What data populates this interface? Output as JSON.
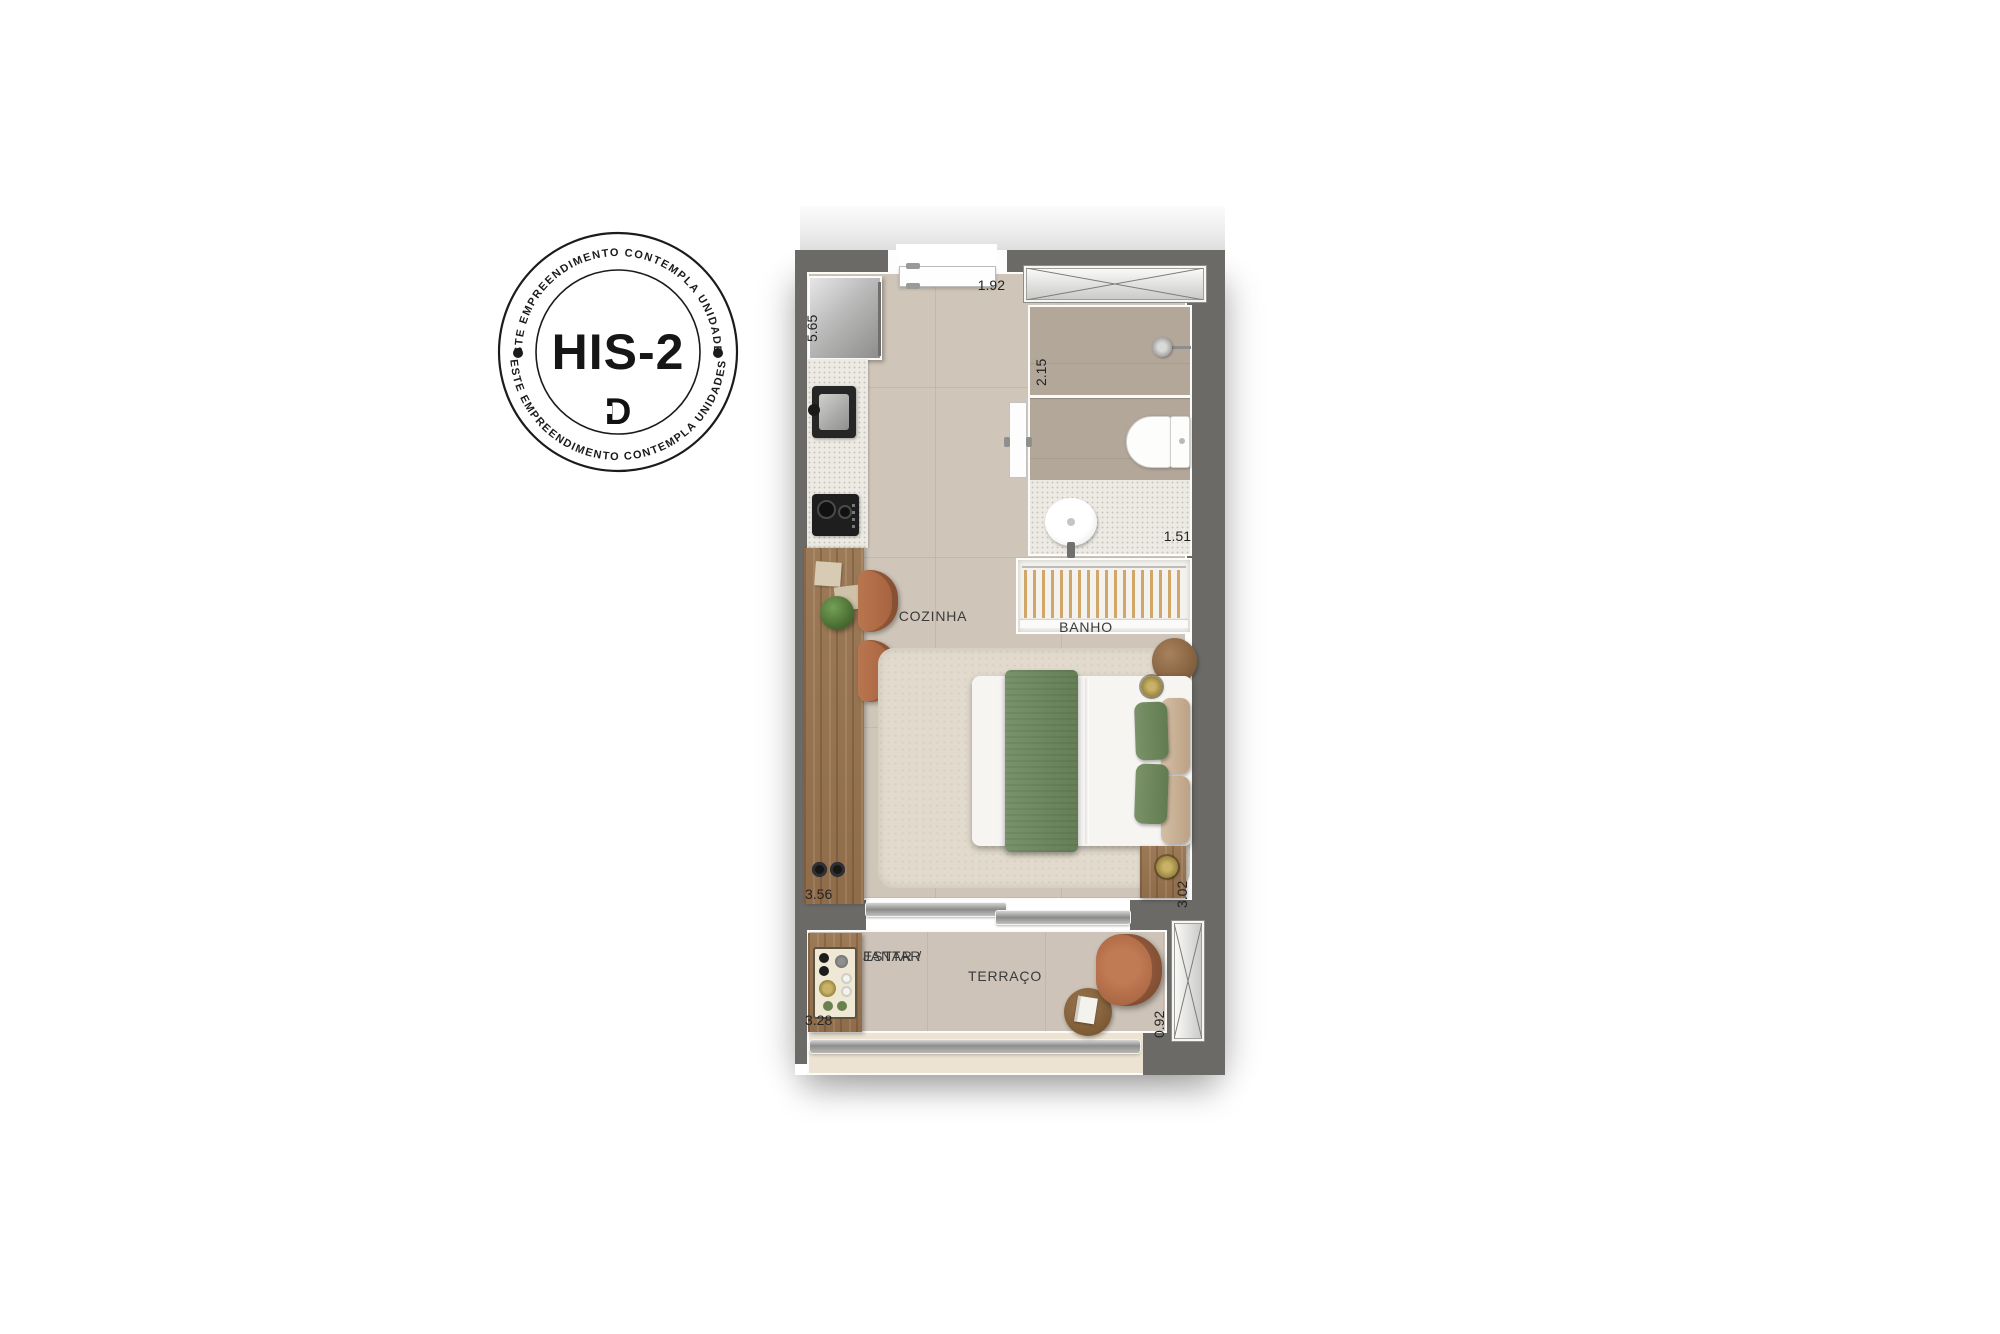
{
  "badge": {
    "ring_text_top": "ESTE EMPREENDIMENTO CONTEMPLA UNIDADES",
    "ring_text_bottom": "ESTE EMPREENDIMENTO CONTEMPLA UNIDADES",
    "title": "HIS-2",
    "logo_letter": "D",
    "ink_color": "#1b1b1b"
  },
  "floor_plan": {
    "rooms": {
      "cozinha": "COZINHA",
      "banho": "BANHO",
      "estar_jantar_line1": "ESTAR /",
      "estar_jantar_line2": "JANTAR",
      "terraco": "TERRAÇO"
    },
    "dimensions": {
      "cozinha_depth": "5.65",
      "entrada_width": "1.92",
      "banho_depth": "2.15",
      "banho_width": "1.51",
      "estar_width": "3.56",
      "estar_depth": "3.02",
      "terraco_width": "3.28",
      "terraco_depth": "0.92"
    },
    "colors": {
      "wall": "#6b6a67",
      "floor": "#cfc5b9",
      "wood": "#96734f",
      "terracotta": "#b06c4c",
      "green": "#6f8a62"
    }
  }
}
